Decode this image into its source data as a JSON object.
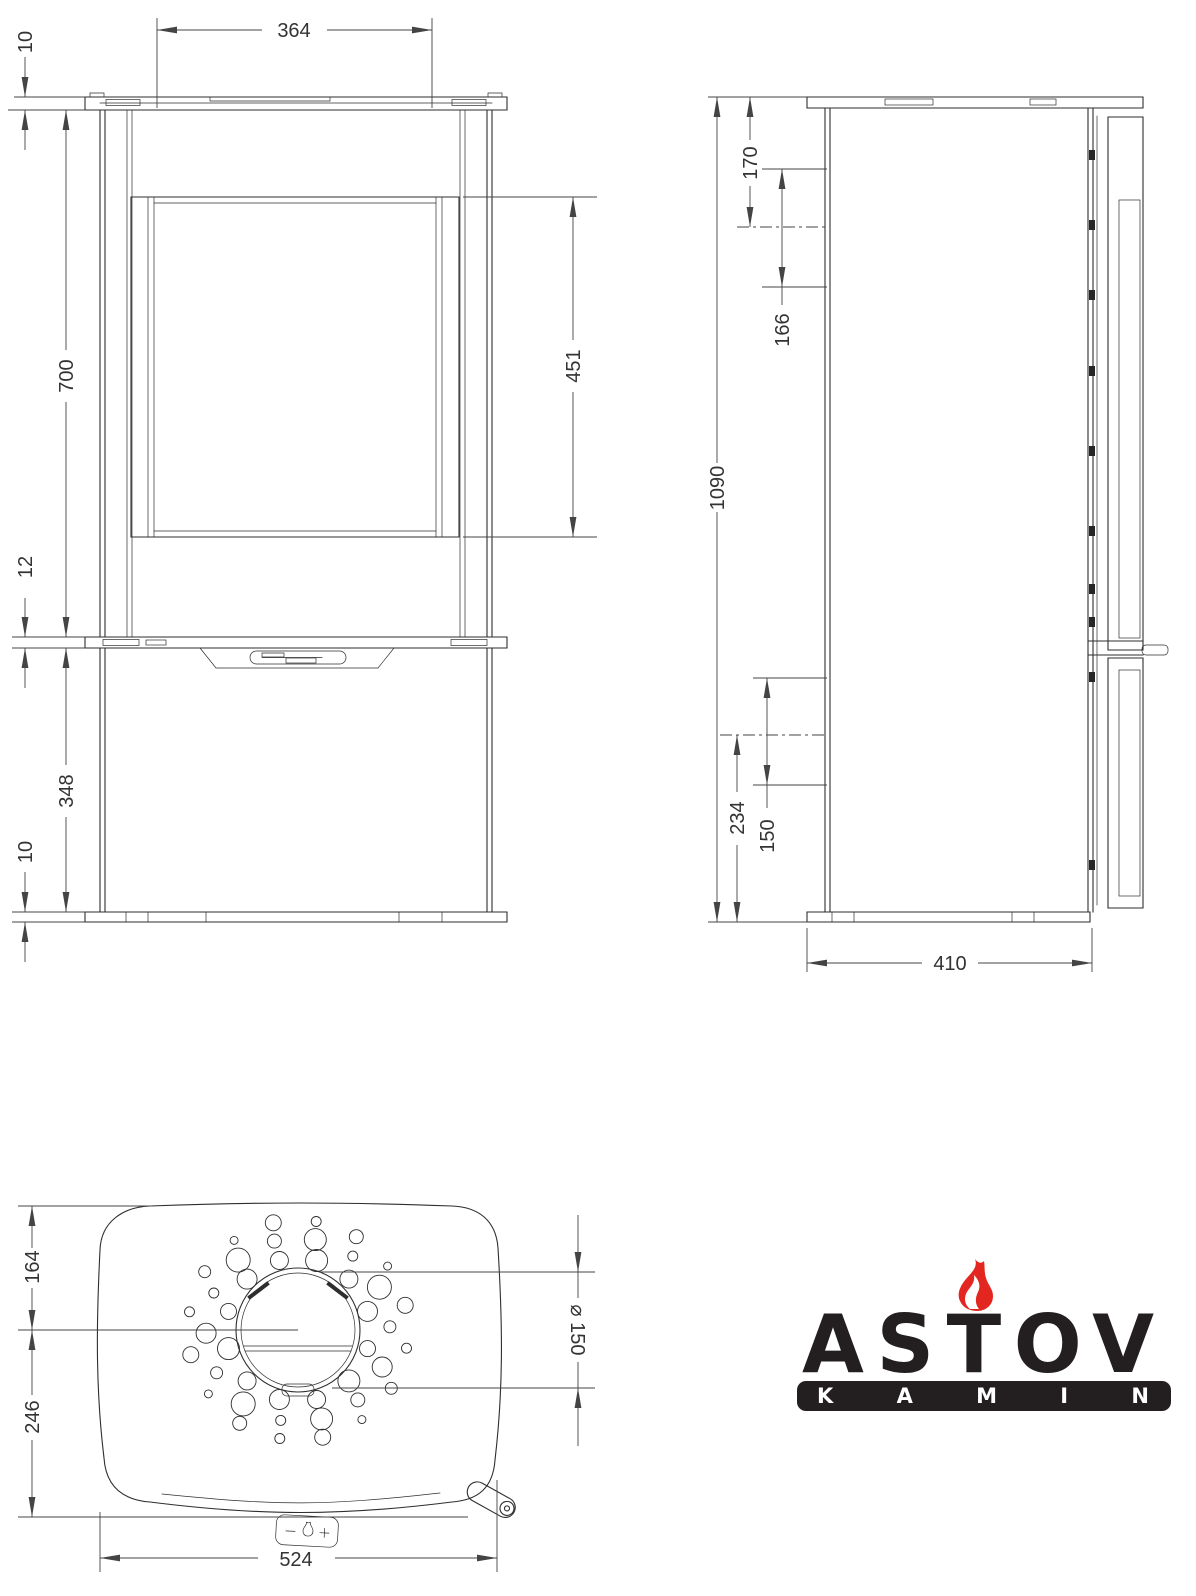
{
  "views": {
    "front": {
      "dims": {
        "top_width": "364",
        "top_plate": "10",
        "upper_height": "700",
        "glass_height": "451",
        "mid_plate": "12",
        "lower_height": "348",
        "base_plate": "10"
      }
    },
    "side": {
      "dims": {
        "total_height": "1090",
        "top_offset": "170",
        "rear_offset": "166",
        "bottom_offset": "234",
        "inlet_span": "150",
        "depth": "410"
      }
    },
    "top": {
      "dims": {
        "front_to_flue": "164",
        "flue_to_back": "246",
        "flue_diameter": "⌀ 150",
        "width": "524"
      }
    }
  },
  "logo": {
    "brand": "ASTOV",
    "subtitle": "KAMIN",
    "flame_color": "#e3261f",
    "bar_color": "#231f20",
    "text_color": "#231f20"
  }
}
